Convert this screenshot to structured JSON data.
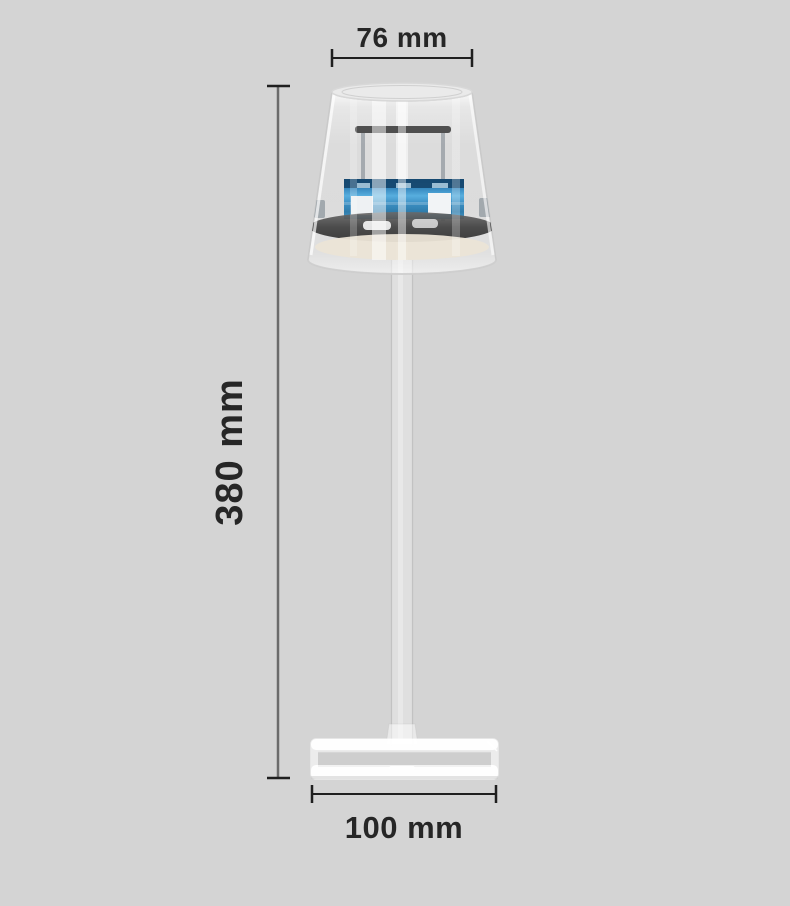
{
  "diagram": {
    "dimensions": {
      "top_width_label": "76 mm",
      "height_label": "380 mm",
      "base_width_label": "100 mm"
    },
    "colors": {
      "background": "#d4d4d4",
      "dimension_text": "#262626",
      "dimension_line": "#1f1f1f",
      "led_panel_blue": "#3b8ec2",
      "led_panel_dark_blue": "#16486f",
      "inner_plate_gray": "#4a4a4a",
      "diffuser_cream": "#ebe4d6",
      "glass_white": "#ffffff"
    }
  }
}
